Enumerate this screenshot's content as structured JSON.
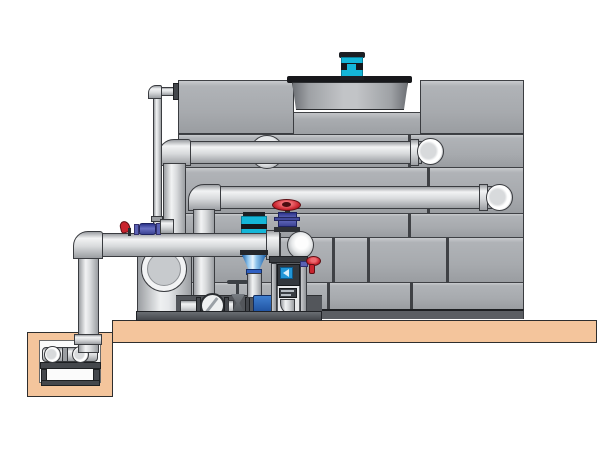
{
  "figure": {
    "type": "technical-illustration",
    "description_visible_text": "",
    "colors": {
      "background": "#ffffff",
      "outline": "#3a3c40",
      "panel": "#a7aaae",
      "panel_light": "#c9cbce",
      "panel_seam": "#3f4145",
      "basin": "#5b5e63",
      "pipe_highlight": "#f2f3f4",
      "pipe_mid": "#d8dadc",
      "pipe_shadow": "#9b9ea2",
      "slab": "#f4c59c",
      "fan_rim": "#17181b",
      "motor_cyan": "#14b6d8",
      "motor_dark": "#1c1f24",
      "valve_red": "#c9242e",
      "valve_purple": "#5a62b4",
      "fitting_blue": "#2f5fc2",
      "pump_blue_light": "#8fc4ec",
      "metal_dark": "#44474c",
      "screen_blue": "#2196d8",
      "pit_interior": "#fbfbfb"
    }
  }
}
